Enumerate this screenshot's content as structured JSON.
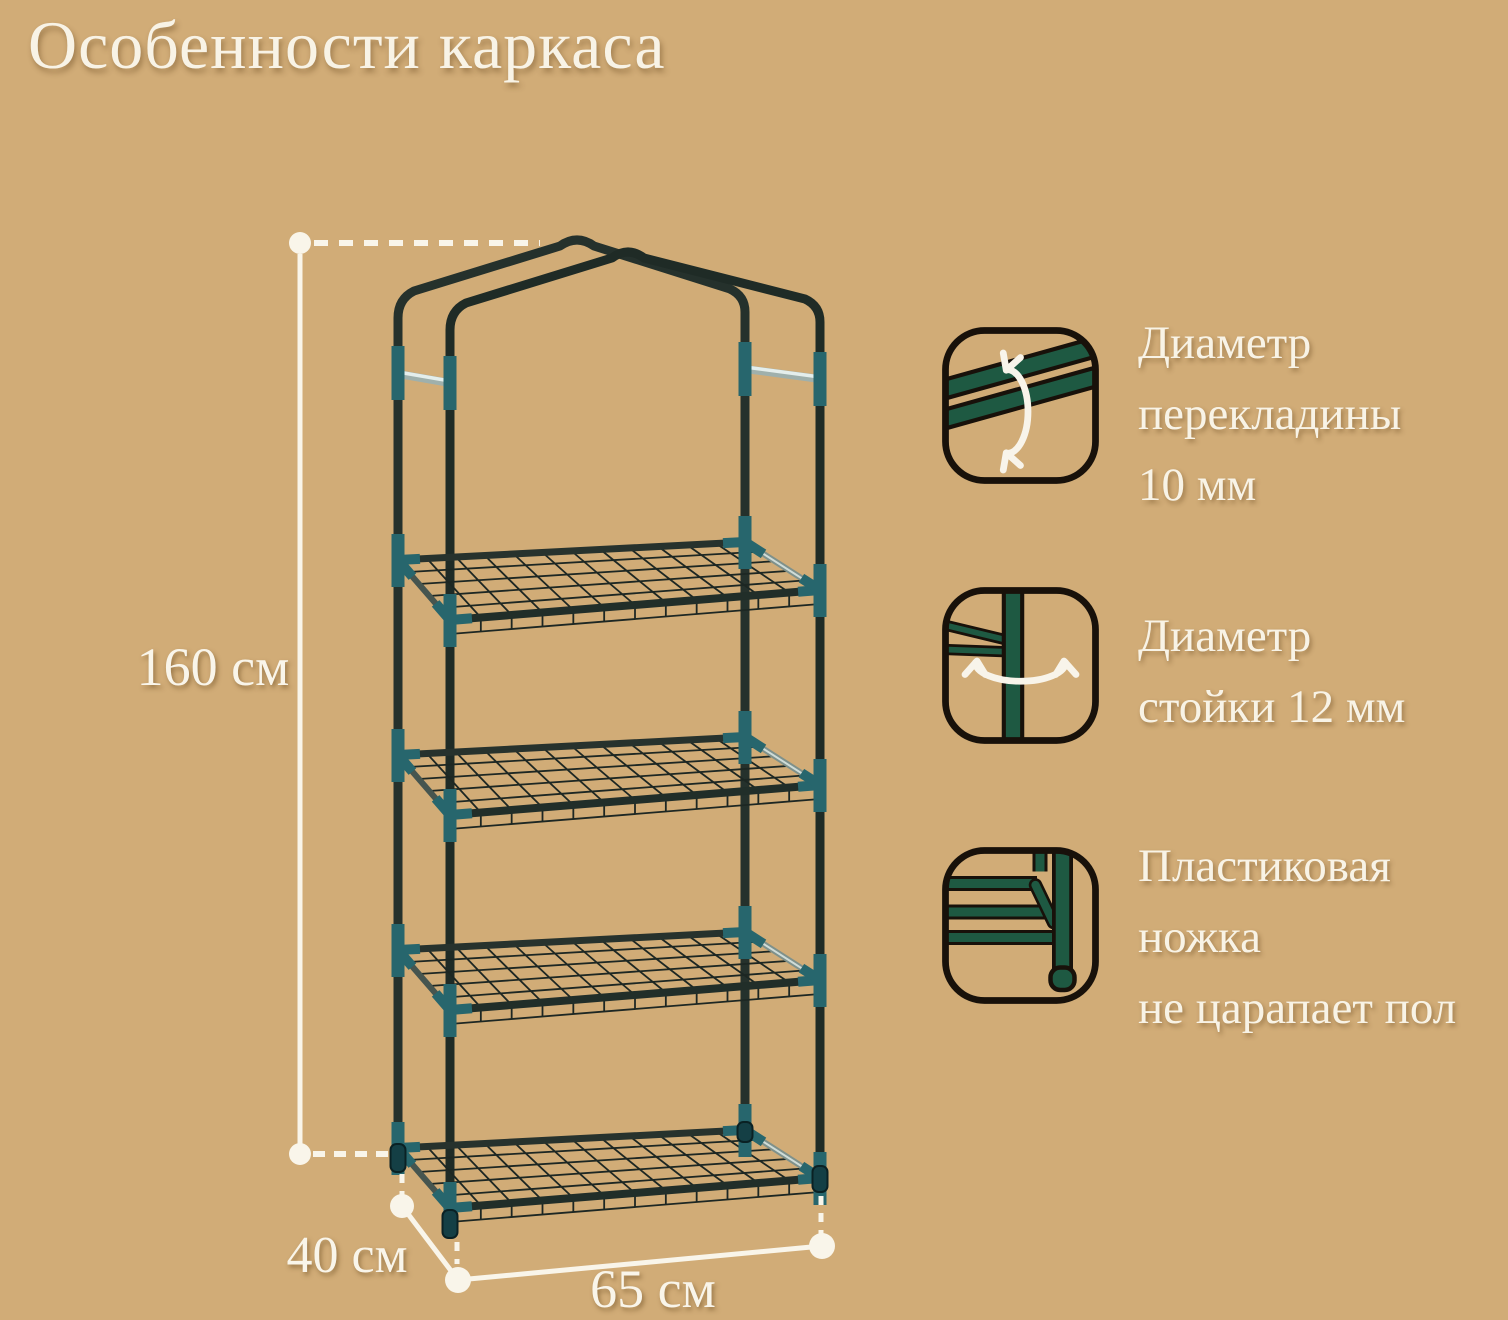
{
  "title": "Особенности каркаса",
  "dimensions": {
    "height": "160 см",
    "depth": "40 см",
    "width": "65 см"
  },
  "callouts": [
    {
      "icon": "crossbar-diameter-icon",
      "lines": [
        "Диаметр",
        "перекладины",
        "10 мм"
      ]
    },
    {
      "icon": "post-diameter-icon",
      "lines": [
        "Диаметр",
        "стойки 12 мм"
      ]
    },
    {
      "icon": "plastic-foot-icon",
      "lines": [
        "Пластиковая",
        "ножка",
        "не царапает пол"
      ]
    }
  ],
  "colors": {
    "background": "#d1ac77",
    "text_cream": "#f8f3e6",
    "dimension_white": "#f9f5ea",
    "frame_tube_dark": "#232f2a",
    "connector_teal": "#27666d",
    "icon_green": "#1e5942",
    "icon_outline": "#18110a",
    "silver_bar": "#e4eeec",
    "wire_grid": "#1d2723"
  }
}
